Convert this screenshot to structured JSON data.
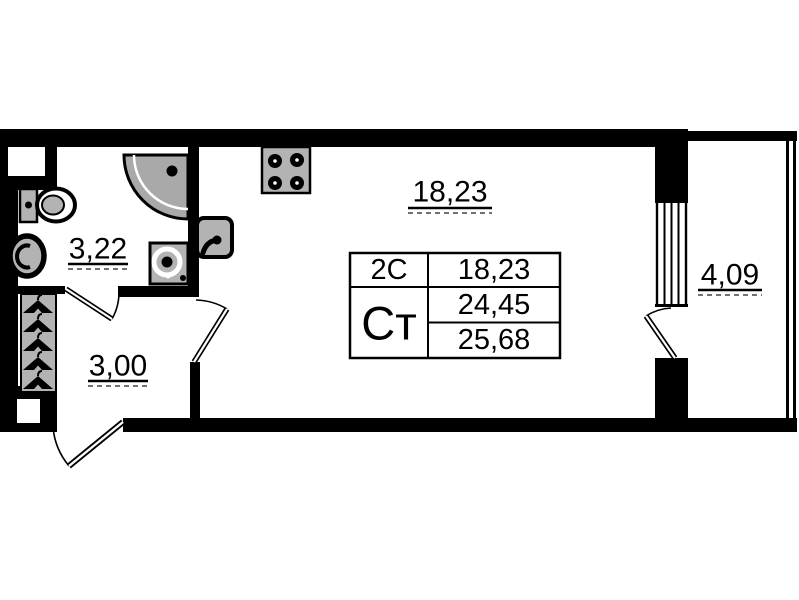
{
  "plan": {
    "title": "studio apartment floor plan",
    "rooms": {
      "living": {
        "label": "18,23"
      },
      "bathroom": {
        "label": "3,22"
      },
      "hall": {
        "label": "3,00"
      },
      "balcony": {
        "label": "4,09"
      }
    },
    "stamp": {
      "type_code": "2С",
      "studio_abbr": "Ст",
      "living_area": "18,23",
      "total_area": "24,45",
      "total_area_with_balcony": "25,68"
    },
    "fixtures": [
      "toilet-icon",
      "bathroom-sink-icon",
      "shower-icon",
      "washing-machine-icon",
      "kitchen-sink-icon",
      "stove-icon",
      "wardrobe-hangers-icon",
      "door-swing-icon"
    ],
    "colors": {
      "wall": "#000000",
      "fixture_fill": "#b3b3b3",
      "shower_fill": "#a9a9a9",
      "background": "#ffffff"
    }
  }
}
